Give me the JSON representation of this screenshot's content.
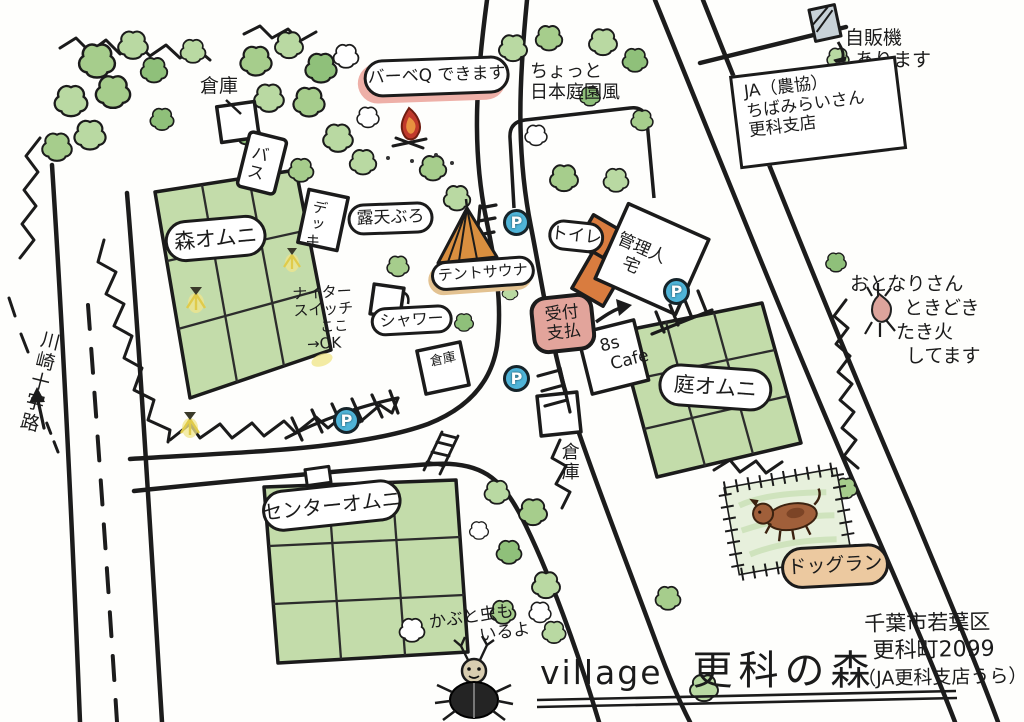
{
  "map_title": {
    "prefix": "village",
    "name": "更科の森"
  },
  "address": {
    "line1": "千葉市若葉区",
    "line2": "更科町2099",
    "line3": "（JA更科支店うら）"
  },
  "roads": {
    "kawasaki_sign": "川崎十字路"
  },
  "ja": {
    "line1": "JA（農協）",
    "line2": "ちばみらいさん",
    "line3": "更科支店"
  },
  "notes": {
    "vending": {
      "line1": "自販機",
      "line2": "あります"
    },
    "garden": {
      "line1": "ちょっと",
      "line2": "日本庭園風"
    },
    "bbq": "バーベQ できます",
    "nighter": {
      "line1": "ナイター",
      "line2": "スイッチ",
      "line3": "ここ",
      "line4": "→OK"
    },
    "neighbor": {
      "line1": "おとなりさん",
      "line2": "ときどき",
      "line3": "たき火",
      "line4": "してます"
    },
    "beetle": {
      "line1": "かぶと虫も",
      "line2": "いるよ"
    }
  },
  "facilities": {
    "storage_top": "倉庫",
    "bus": "バス",
    "deck": "デッキ",
    "rotenburo": "露天ぶろ",
    "tent_sauna": "テントサウナ",
    "shower": "シャワー",
    "toilet": "トイレ",
    "manager": {
      "line1": "管理人",
      "line2": "宅"
    },
    "reception": {
      "line1": "受付",
      "line2": "支払"
    },
    "cafe": {
      "line1": "8s",
      "line2": "Cafe"
    },
    "storage_mid": "倉庫",
    "storage_bottom": "倉庫",
    "court_mori": "森オムニ",
    "court_niwa": "庭オムニ",
    "court_center": "センターオムニ",
    "dog_run": "ドッグラン"
  },
  "parking": {
    "label": "P"
  },
  "colors": {
    "court_green": "#c3dcaa",
    "tree_green": "#a6cd8c",
    "parking_blue": "#4fb4d8",
    "tent_orange": "#d98f3f",
    "building_orange": "#d97c3f",
    "reception_pink": "#e2a49b",
    "dogrun_tan": "#ecc9a0",
    "bbq_pink": "#eeb0a8",
    "lamp_yellow": "#f0e68c",
    "ink": "#1b1b1b"
  }
}
